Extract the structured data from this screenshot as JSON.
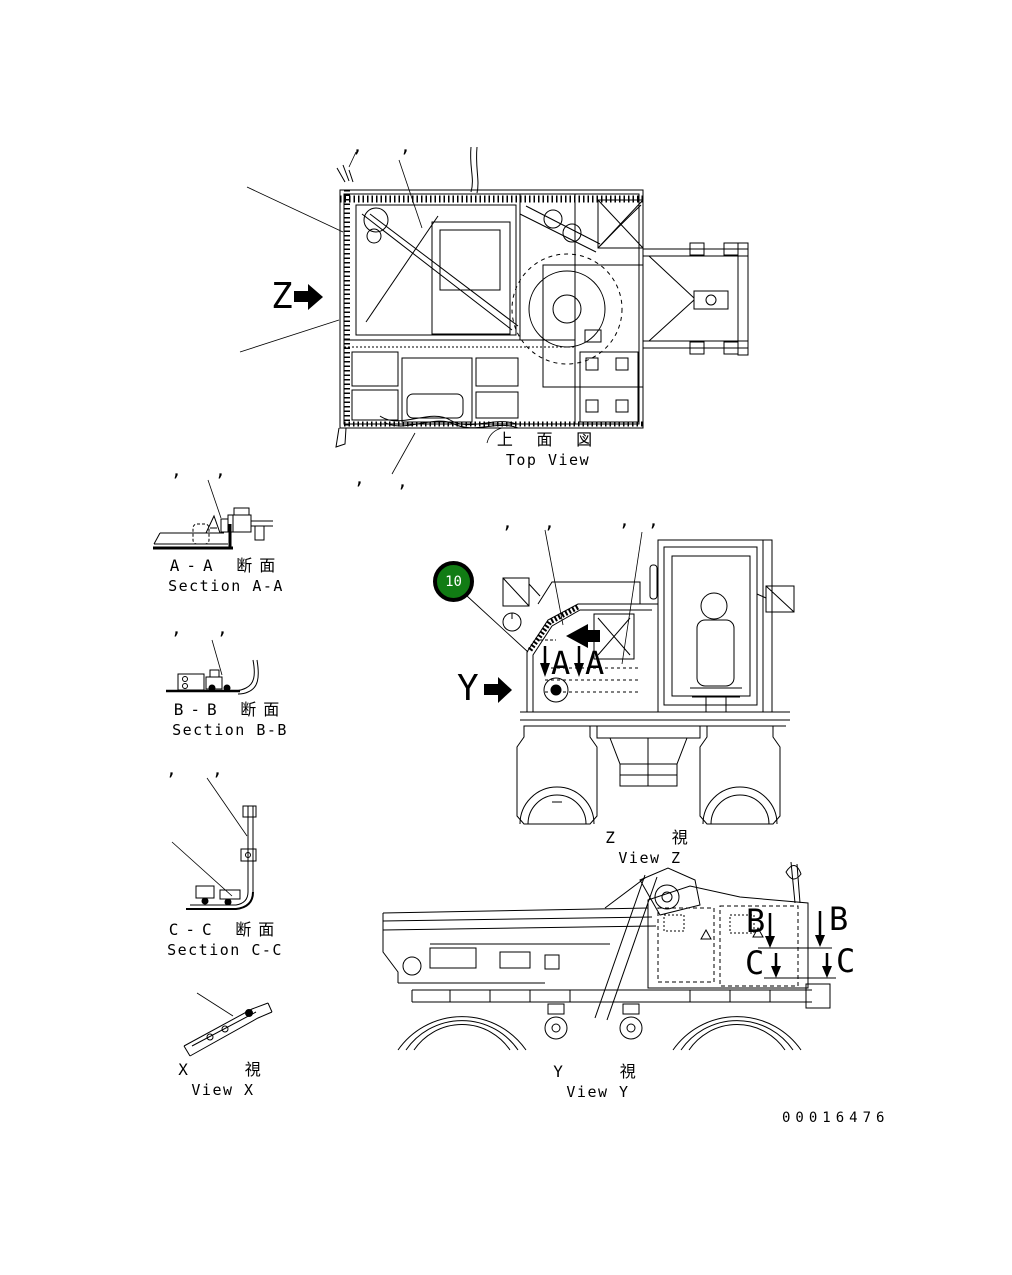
{
  "page": {
    "background": "#ffffff",
    "line_color": "#000000",
    "doc_number": "00016476"
  },
  "callout": {
    "number": "10",
    "color": "#117c14",
    "text_color": "#ffffff"
  },
  "marks": {
    "comma": ","
  },
  "markers": {
    "z": "Z",
    "y": "Y",
    "a": "A",
    "b": "B",
    "c": "C"
  },
  "labels": {
    "top_view": {
      "jp": "上 面 図",
      "en": "Top View"
    },
    "section_aa": {
      "jp": "A-A 断面",
      "en": "Section A-A"
    },
    "section_bb": {
      "jp": "B-B 断面",
      "en": "Section B-B"
    },
    "section_cc": {
      "jp": "C-C 断面",
      "en": "Section C-C"
    },
    "view_x": {
      "jp": "X   視",
      "en": "View X"
    },
    "view_z": {
      "jp": "Z   視",
      "en": "View Z"
    },
    "view_y": {
      "jp": "Y   視",
      "en": "View Y"
    }
  }
}
